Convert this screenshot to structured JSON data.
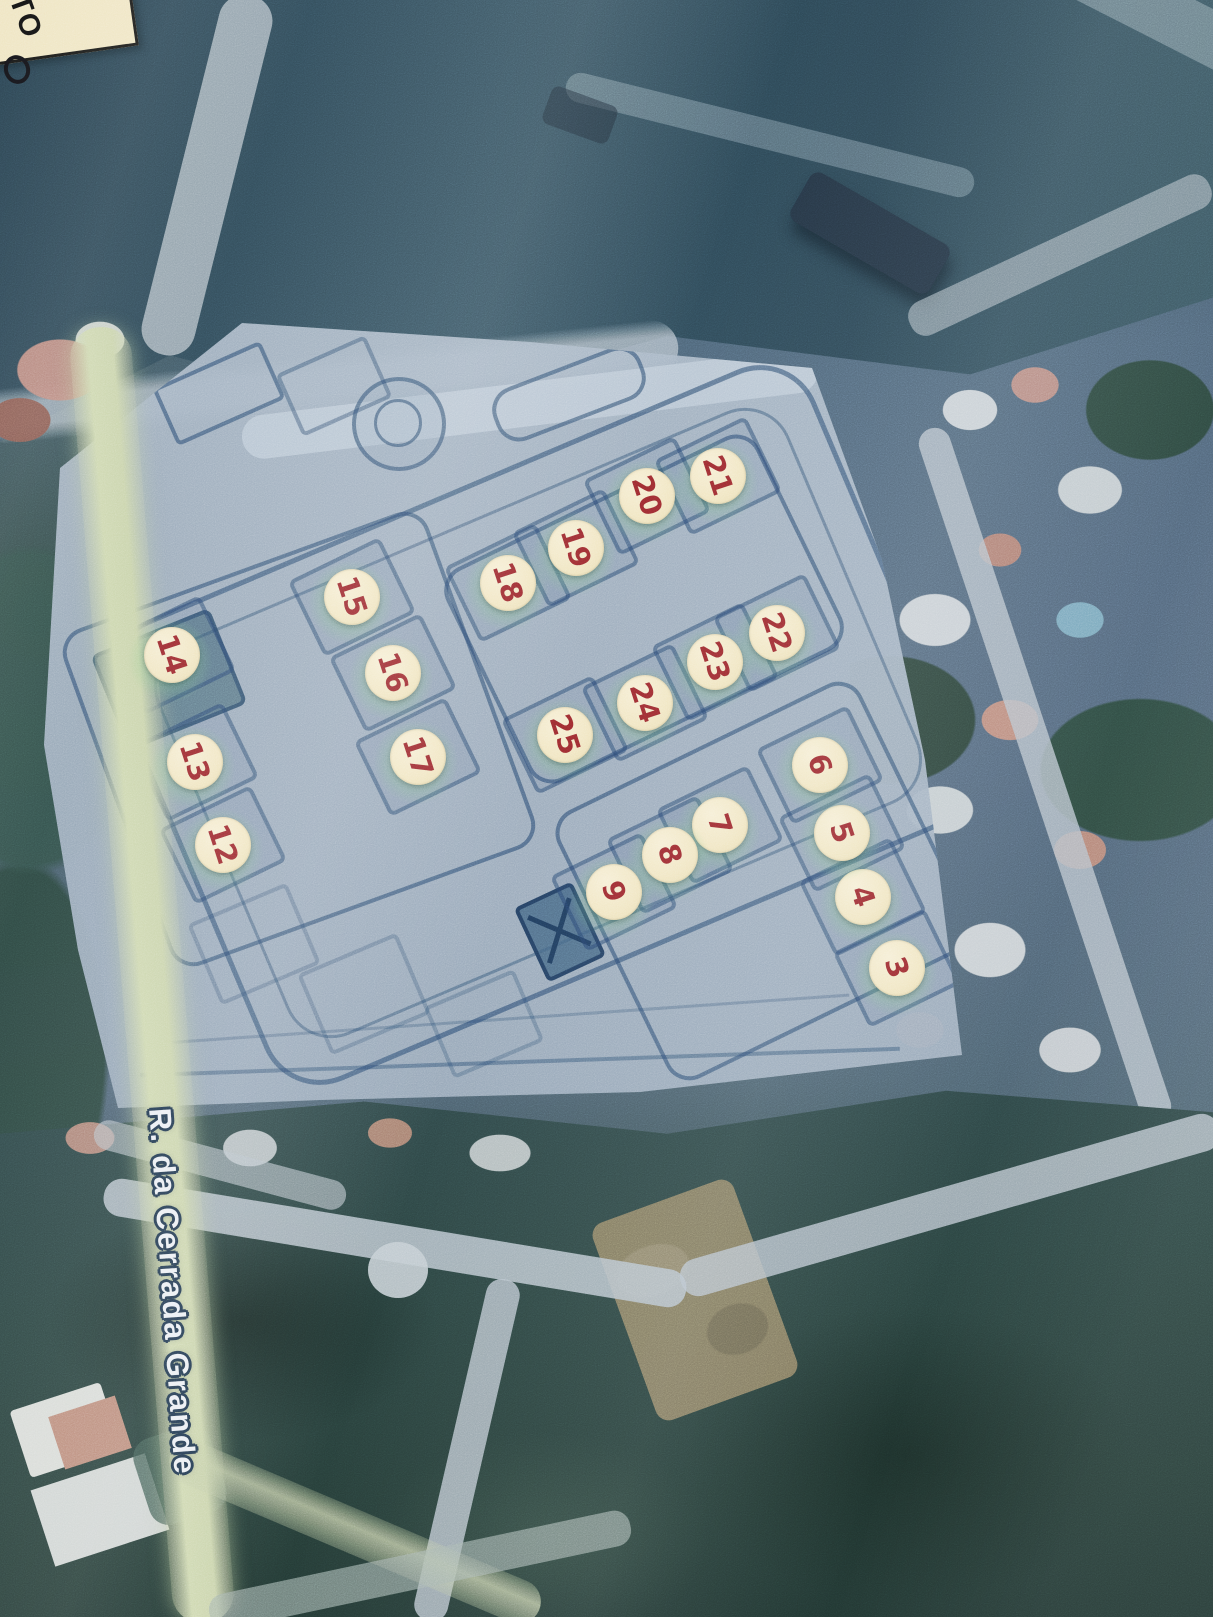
{
  "map": {
    "street_label": "R. da Cerrada Grande",
    "corner_label_text": "TO"
  },
  "colors": {
    "marker_fill": "#f1e6c2",
    "marker_number": "#9a2b30",
    "plan_background": "#a2b1c1",
    "plan_line": "#26446c",
    "road_yellow": "#c9d3aa",
    "street_label_fill": "#eaeef3",
    "street_label_outline": "#20364c"
  },
  "markers": {
    "items": [
      {
        "label": "3",
        "x": 897,
        "y": 968
      },
      {
        "label": "4",
        "x": 863,
        "y": 897
      },
      {
        "label": "5",
        "x": 842,
        "y": 833
      },
      {
        "label": "6",
        "x": 820,
        "y": 765
      },
      {
        "label": "7",
        "x": 720,
        "y": 825
      },
      {
        "label": "8",
        "x": 670,
        "y": 855
      },
      {
        "label": "9",
        "x": 614,
        "y": 892
      },
      {
        "label": "12",
        "x": 223,
        "y": 845
      },
      {
        "label": "13",
        "x": 195,
        "y": 762
      },
      {
        "label": "14",
        "x": 172,
        "y": 655
      },
      {
        "label": "15",
        "x": 352,
        "y": 597
      },
      {
        "label": "16",
        "x": 393,
        "y": 673
      },
      {
        "label": "17",
        "x": 418,
        "y": 757
      },
      {
        "label": "18",
        "x": 508,
        "y": 583
      },
      {
        "label": "19",
        "x": 576,
        "y": 548
      },
      {
        "label": "20",
        "x": 647,
        "y": 496
      },
      {
        "label": "21",
        "x": 718,
        "y": 476
      },
      {
        "label": "22",
        "x": 777,
        "y": 633
      },
      {
        "label": "23",
        "x": 715,
        "y": 662
      },
      {
        "label": "24",
        "x": 645,
        "y": 703
      },
      {
        "label": "25",
        "x": 565,
        "y": 735
      }
    ]
  }
}
